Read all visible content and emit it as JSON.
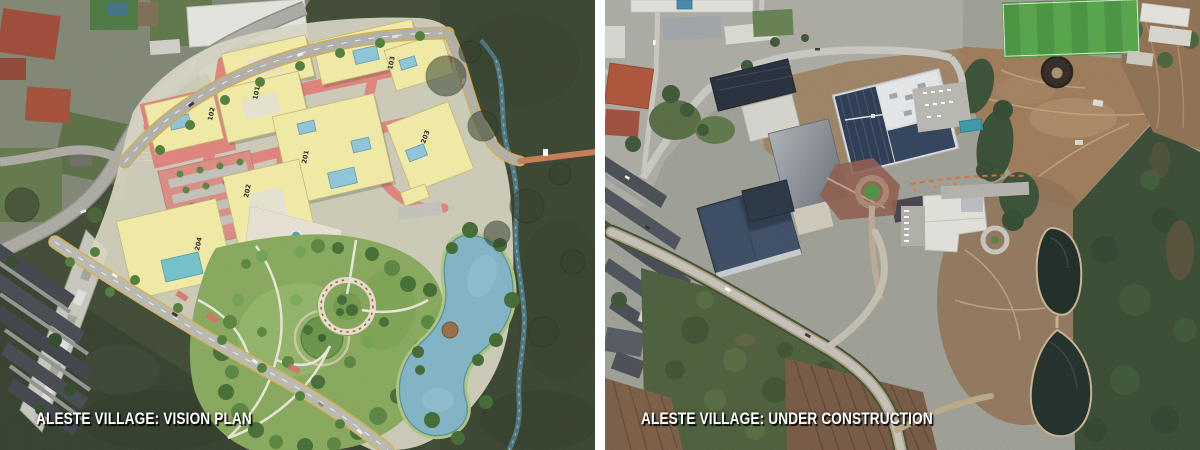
{
  "stage": {
    "width": 1200,
    "height": 450
  },
  "left_panel": {
    "caption": "ALESTE VILLAGE: VISION PLAN",
    "building_labels": {
      "b101": "101",
      "b102": "102",
      "b103": "103",
      "b201": "201",
      "b202": "202",
      "b203": "203",
      "b204": "204"
    }
  },
  "right_panel": {
    "caption": "ALESTE VILLAGE: UNDER CONSTRUCTION"
  },
  "palette": {
    "caption_text": "#ffffff",
    "caption_shadow": "#000000",
    "divider": "#ffffff",
    "plan_building_yellow": "#f4eda4",
    "plan_street_red": "#e08078",
    "plan_park_green": "#84a757",
    "plan_pond_blue": "#7db3c6",
    "forest_green": "#39452e",
    "satellite_roof_navy": "#22334a",
    "soccer_field_green": "#3f8f35",
    "dirt_brown": "#9a744e",
    "retention_pond_dark": "#101e18"
  }
}
